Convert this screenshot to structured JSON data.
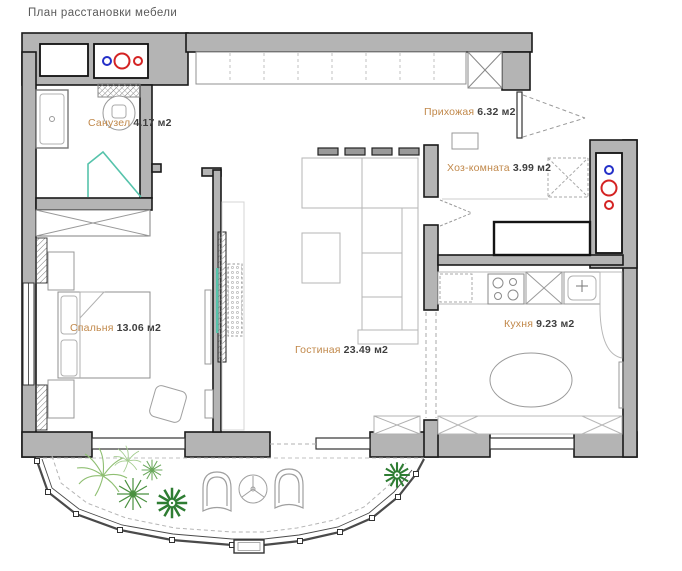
{
  "title": "План расстановки мебели",
  "rooms": [
    {
      "name": "Санузел",
      "area": "4.17 м2"
    },
    {
      "name": "Прихожая",
      "area": "6.32 м2"
    },
    {
      "name": "Хоз-комната",
      "area": "3.99 м2"
    },
    {
      "name": "Спальня",
      "area": "13.06 м2"
    },
    {
      "name": "Гостиная",
      "area": "23.49 м2"
    },
    {
      "name": "Кухня",
      "area": "9.23 м2"
    }
  ],
  "colors": {
    "wall_fill": "#b4b4b4",
    "wall_edge": "#1a1a1a",
    "room_name_text": "#c1884a",
    "area_text": "#3f3f3f",
    "accent_teal": "#56c3ab",
    "plant_green": "#4a9140",
    "meter_blue": "#2430c8",
    "meter_red": "#d42323"
  }
}
